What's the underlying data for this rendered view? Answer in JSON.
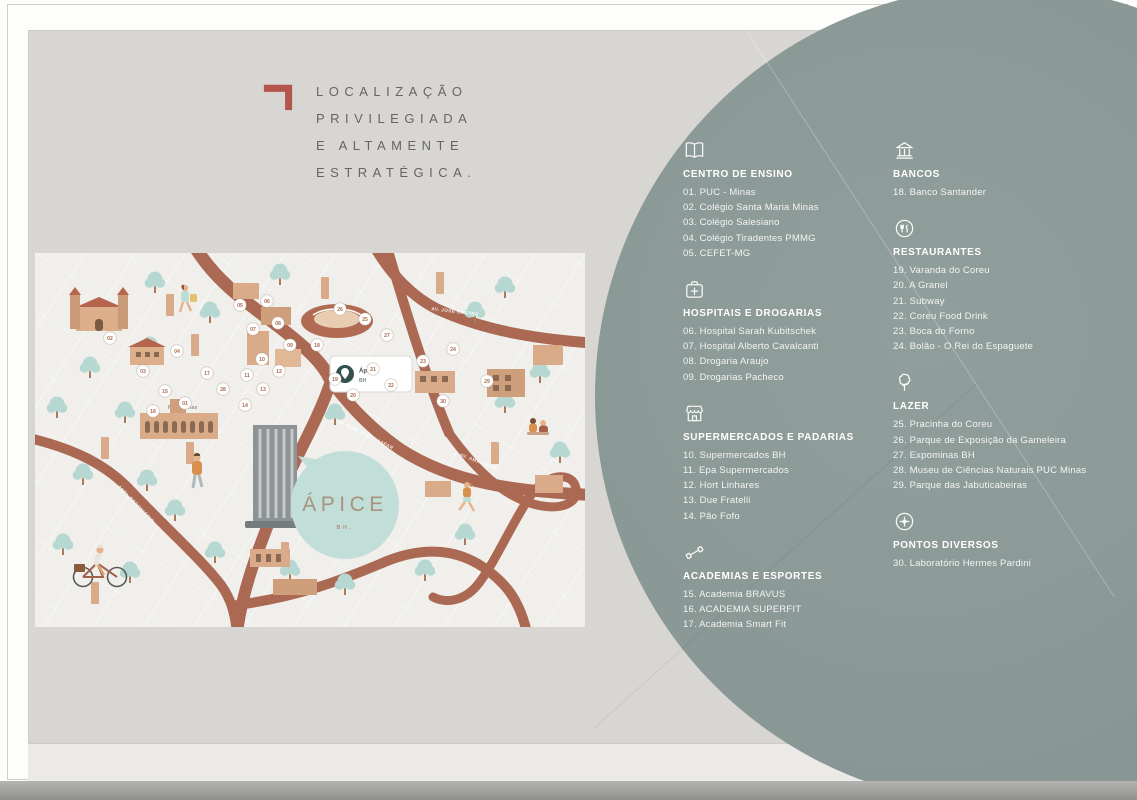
{
  "header": {
    "lines": [
      "LOCALIZAÇÃO",
      "PRIVILEGIADA",
      "E ALTAMENTE",
      "ESTRATÉGICA."
    ]
  },
  "colors": {
    "accent": "#b5564c",
    "circle": "#8a9896",
    "card_bg": "#d8d6d3",
    "map_bg": "#f0efeb",
    "road": "#ab6852",
    "tree": "#b7d8d2",
    "balloon": "#c2ded8"
  },
  "map": {
    "balloon": {
      "name": "ÁPICE",
      "subtitle": "BH."
    },
    "pin_card": {
      "line1": "Ápice",
      "line2": "BH"
    },
    "building_label": "PUC Minas",
    "road_labels": [
      {
        "text": "AV. JOSÉ CASTRO"
      },
      {
        "text": "AV. DOM JOSÉ GASPAR"
      },
      {
        "text": "AV. AMAZONAS"
      },
      {
        "text": "ANEL RODOVIÁRIO"
      }
    ],
    "markers": [
      {
        "n": "01",
        "x": 150,
        "y": 150
      },
      {
        "n": "02",
        "x": 75,
        "y": 85
      },
      {
        "n": "03",
        "x": 108,
        "y": 118
      },
      {
        "n": "04",
        "x": 142,
        "y": 98
      },
      {
        "n": "05",
        "x": 205,
        "y": 52
      },
      {
        "n": "06",
        "x": 232,
        "y": 48
      },
      {
        "n": "07",
        "x": 218,
        "y": 76
      },
      {
        "n": "08",
        "x": 243,
        "y": 70
      },
      {
        "n": "09",
        "x": 255,
        "y": 92
      },
      {
        "n": "10",
        "x": 227,
        "y": 106
      },
      {
        "n": "11",
        "x": 212,
        "y": 122
      },
      {
        "n": "12",
        "x": 244,
        "y": 118
      },
      {
        "n": "13",
        "x": 228,
        "y": 136
      },
      {
        "n": "14",
        "x": 210,
        "y": 152
      },
      {
        "n": "15",
        "x": 130,
        "y": 138
      },
      {
        "n": "16",
        "x": 118,
        "y": 158
      },
      {
        "n": "17",
        "x": 172,
        "y": 120
      },
      {
        "n": "18",
        "x": 282,
        "y": 92
      },
      {
        "n": "19",
        "x": 300,
        "y": 126
      },
      {
        "n": "20",
        "x": 318,
        "y": 142
      },
      {
        "n": "21",
        "x": 338,
        "y": 116
      },
      {
        "n": "22",
        "x": 356,
        "y": 132
      },
      {
        "n": "23",
        "x": 388,
        "y": 108
      },
      {
        "n": "24",
        "x": 418,
        "y": 96
      },
      {
        "n": "25",
        "x": 330,
        "y": 66
      },
      {
        "n": "26",
        "x": 305,
        "y": 56
      },
      {
        "n": "27",
        "x": 352,
        "y": 82
      },
      {
        "n": "28",
        "x": 188,
        "y": 136
      },
      {
        "n": "29",
        "x": 452,
        "y": 128
      },
      {
        "n": "30",
        "x": 408,
        "y": 148
      }
    ]
  },
  "legend": {
    "columns": [
      {
        "sections": [
          {
            "icon": "book-icon",
            "title": "CENTRO DE ENSINO",
            "items": [
              "01. PUC - Minas",
              "02. Colégio Santa Maria Minas",
              "03. Colégio Salesiano",
              "04. Colégio Tiradentes PMMG",
              "05. CEFET-MG"
            ]
          },
          {
            "icon": "first-aid-icon",
            "title": "HOSPITAIS E DROGARIAS",
            "items": [
              "06. Hospital Sarah Kubitschek",
              "07. Hospital Alberto Cavalcanti",
              "08. Drogaria Araujo",
              "09. Drogarias Pacheco"
            ]
          },
          {
            "icon": "storefront-icon",
            "title": "SUPERMERCADOS E PADARIAS",
            "items": [
              "10. Supermercados BH",
              "11. Epa Supermercados",
              "12. Hort Linhares",
              "13. Due Fratelli",
              "14. Pão Fofo"
            ]
          },
          {
            "icon": "dumbbell-icon",
            "title": "ACADEMIAS E ESPORTES",
            "items": [
              "15. Academia BRAVUS",
              "16. ACADEMIA SUPERFIT",
              "17. Academia Smart Fit"
            ]
          }
        ]
      },
      {
        "sections": [
          {
            "icon": "bank-icon",
            "title": "BANCOS",
            "items": [
              "18. Banco Santander"
            ]
          },
          {
            "icon": "restaurant-icon",
            "title": "RESTAURANTES",
            "items": [
              "19. Varanda do Coreu",
              "20. A Granel",
              "21. Subway",
              "22. Coreu Food Drink",
              "23. Boca do Forno",
              "24. Bolão - O Rei do Espaguete"
            ]
          },
          {
            "icon": "tree-icon",
            "title": "LAZER",
            "items": [
              "25. Pracinha do Coreu",
              "26. Parque de Exposição da Gameleira",
              "27. Expominas BH",
              "28. Museu de Ciências Naturais PUC Minas",
              "29. Parque das Jabuticabeiras"
            ]
          },
          {
            "icon": "plus-circle-icon",
            "title": "PONTOS DIVERSOS",
            "items": [
              "30. Laboratório Hermes Pardini"
            ]
          }
        ]
      }
    ]
  }
}
